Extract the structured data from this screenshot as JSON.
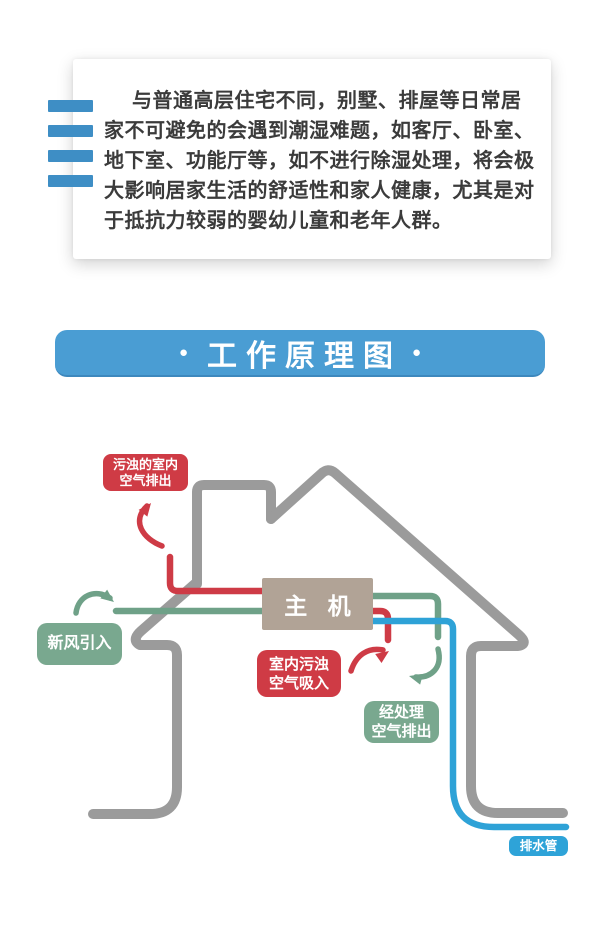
{
  "intro": {
    "lines": [
      "与普通高层住宅不同，别墅、排屋等日常居",
      "家不可避免的会遇到潮湿难题，如客厅、卧室、",
      "地下室、功能厅等，如不进行除湿处理，将会极",
      "大影响居家生活的舒适性和家人健康，尤其是对",
      "于抵抗力较弱的婴幼儿童和老年人群。"
    ]
  },
  "banner": {
    "bullet": "●",
    "title": "工作原理图",
    "bg": "#4A9DD3"
  },
  "accent_bars": {
    "count": 4,
    "color": "#3E8EC5"
  },
  "diagram": {
    "unit_label": "主 机",
    "labels": {
      "exhaust_top": {
        "line1": "污浊的室内",
        "line2": "空气排出",
        "color": "#CF3B45"
      },
      "fresh_air": {
        "line1": "新风引入",
        "color": "#79A88F"
      },
      "indoor_intake": {
        "line1": "室内污浊",
        "line2": "空气吸入",
        "color": "#CF3B45"
      },
      "treated_out": {
        "line1": "经处理",
        "line2": "空气排出",
        "color": "#79A88F"
      },
      "drain": {
        "line1": "排水管",
        "color": "#2EA3D8"
      }
    },
    "colors": {
      "house": "#9B9B9B",
      "red": "#CE3B46",
      "green": "#6FA188",
      "blue": "#2EA2D7",
      "unit_box": "#B1A396"
    }
  }
}
